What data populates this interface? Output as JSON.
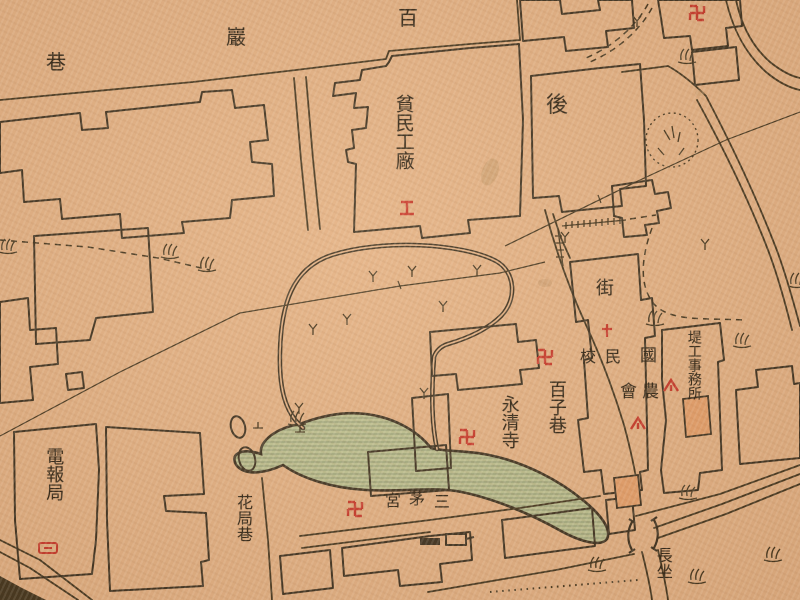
{
  "map": {
    "kind": "historical-chinese-city-map",
    "language": "zh-Hant",
    "palette": {
      "paper": "#e3b184",
      "ink": "#3c3120",
      "red_symbol": "#c8392b",
      "pond_green": "#bcc191",
      "pond_hatch": "#8f9a74",
      "orange_building": "#e5a06b",
      "stain": "#c69a6b"
    },
    "labels": {
      "top_street": {
        "reading_right_to_left": "百巖巷",
        "chars": [
          "百",
          "巖",
          "巷"
        ]
      },
      "poor_peoples_factory": {
        "text": "貧民工廠"
      },
      "hou": {
        "text": "後"
      },
      "jie": {
        "text": "街"
      },
      "national_school": {
        "reading_right_to_left": "國民校",
        "chars": [
          "校",
          "民",
          "國"
        ]
      },
      "farmers_association": {
        "reading_right_to_left": "農會",
        "chars": [
          "會",
          "農"
        ]
      },
      "dike_works_office": {
        "text": "堤工事務所"
      },
      "baizi_lane": {
        "text": "百子巷"
      },
      "yongqing_temple": {
        "text": "永清寺"
      },
      "sanmao_palace": {
        "reading_right_to_left": "三茅宮",
        "chars": [
          "宮",
          "茅",
          "三"
        ]
      },
      "telegraph_bureau": {
        "text": "電報局"
      },
      "flower_bureau_lane": {
        "text": "花局巷"
      },
      "changzuo": {
        "text": "長坐"
      }
    },
    "symbols": {
      "temple_swastika": "卍",
      "factory_mark": "工",
      "cross_mark": "十",
      "camp_mark": "△",
      "telegraph_mark": "envelope",
      "bridge_mark": ")(",
      "grass_mark": "tuft",
      "marsh_mark": "y",
      "pond_small": "oval",
      "mound": "dotted-circle"
    }
  }
}
